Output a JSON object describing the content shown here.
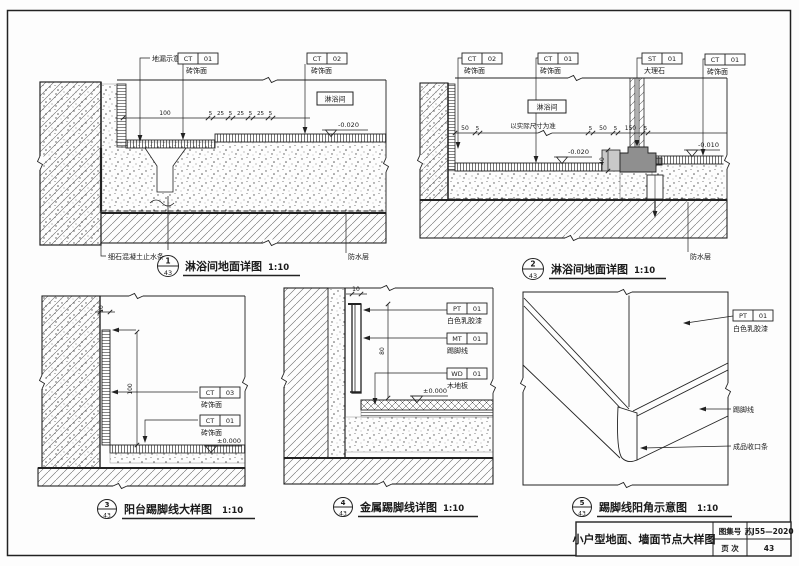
{
  "sheet": {
    "kind": "construction detail sheet",
    "line_color": "#222222",
    "marble_color": "#8f8f8f"
  },
  "details": {
    "d1": {
      "num": "1",
      "sheet": "43",
      "title": "淋浴间地面详图",
      "scale": "1:10",
      "room": "淋浴间",
      "drain_label": "地漏示意",
      "waterstop": "细石混凝土止水条",
      "waterproof": "防水层",
      "elev": "-0.020",
      "tags": {
        "ct01": {
          "code": "CT",
          "no": "01",
          "desc": "砖饰面"
        },
        "ct02": {
          "code": "CT",
          "no": "02",
          "desc": "砖饰面"
        }
      },
      "dims": [
        "100",
        "5",
        "25",
        "5",
        "25",
        "5",
        "25",
        "5"
      ]
    },
    "d2": {
      "num": "2",
      "sheet": "43",
      "title": "淋浴间地面详图",
      "scale": "1:10",
      "room": "淋浴间",
      "actual_note": "以实际尺寸为准",
      "waterproof": "防水层",
      "elev_shower": "-0.020",
      "elev_floor": "-0.010",
      "vdim": "40",
      "tags": {
        "ct02": {
          "code": "CT",
          "no": "02",
          "desc": "砖饰面"
        },
        "ct01a": {
          "code": "CT",
          "no": "01",
          "desc": "砖饰面"
        },
        "st01": {
          "code": "ST",
          "no": "01",
          "desc": "大理石"
        },
        "ct01b": {
          "code": "CT",
          "no": "01",
          "desc": "砖饰面"
        }
      },
      "dims": [
        "50",
        "5",
        "5",
        "50",
        "5",
        "150",
        "5"
      ]
    },
    "d3": {
      "num": "3",
      "sheet": "43",
      "title": "阳台踢脚线大样图",
      "scale": "1:10",
      "elev": "±0.000",
      "tags": {
        "ct03": {
          "code": "CT",
          "no": "03",
          "desc": "砖饰面"
        },
        "ct01": {
          "code": "CT",
          "no": "01",
          "desc": "砖饰面"
        }
      },
      "dims": [
        "10",
        "100"
      ]
    },
    "d4": {
      "num": "4",
      "sheet": "43",
      "title": "金属踢脚线详图",
      "scale": "1:10",
      "elev": "±0.000",
      "tags": {
        "pt01": {
          "code": "PT",
          "no": "01",
          "desc": "白色乳胶漆"
        },
        "mt01": {
          "code": "MT",
          "no": "01",
          "desc": "踢脚线"
        },
        "wd01": {
          "code": "WD",
          "no": "01",
          "desc": "木地板"
        }
      },
      "dims": [
        "10",
        "80"
      ]
    },
    "d5": {
      "num": "5",
      "sheet": "43",
      "title": "踢脚线阳角示意图",
      "scale": "1:10",
      "tags": {
        "pt01": {
          "code": "PT",
          "no": "01",
          "desc": "白色乳胶漆"
        }
      },
      "labels": {
        "skirting": "踢脚线",
        "trim": "成品收口条"
      }
    }
  },
  "title_block": {
    "title": "小户型地面、墙面节点大样图",
    "atlas_label": "图集号",
    "atlas_value": "苏J55—2020",
    "page_label": "页 次",
    "page_value": "43"
  }
}
